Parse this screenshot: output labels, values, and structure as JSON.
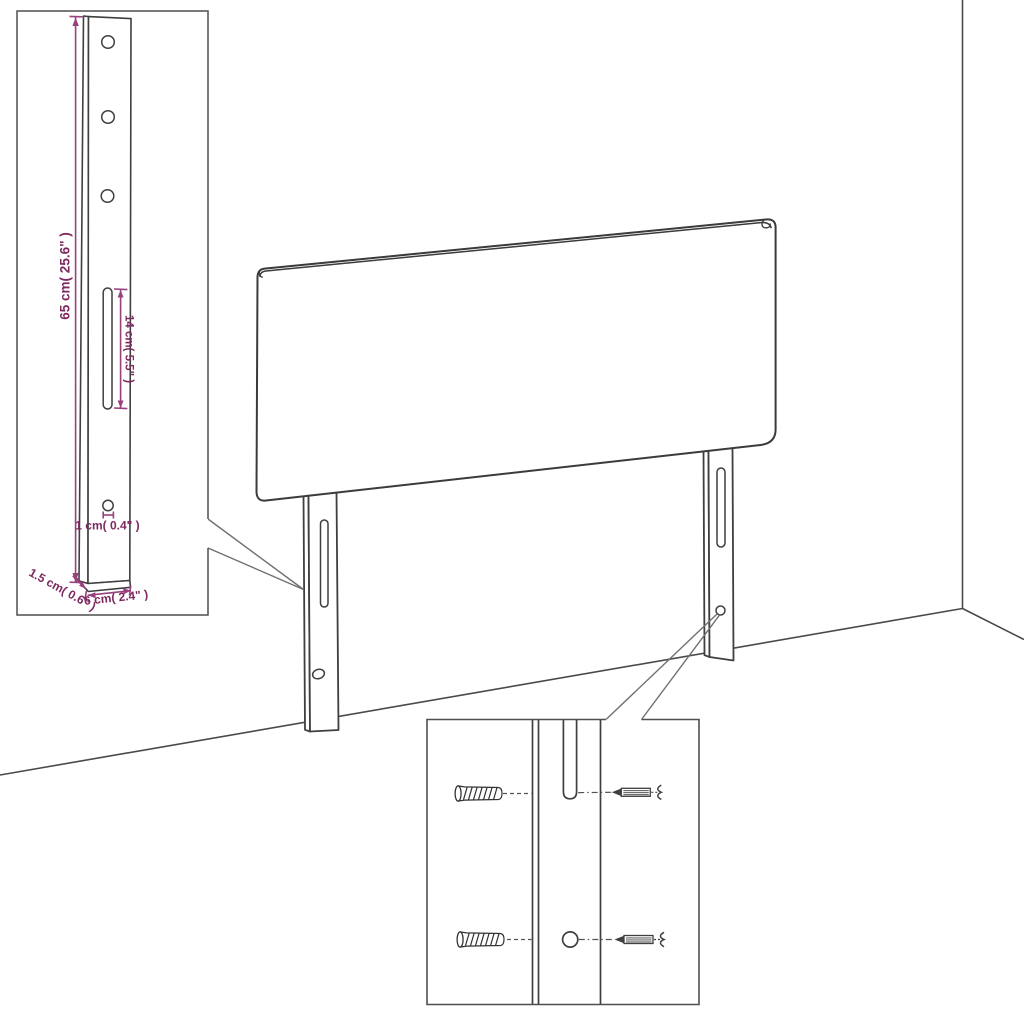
{
  "diagram": {
    "type": "headboard-assembly-dimension-diagram",
    "labels": {
      "bracket_height": "65 cm( 25.6\" )",
      "slot_length": "14 cm( 5.5\" )",
      "hole_diameter": "1 cm( 0.4\" )",
      "bracket_depth": "1.5 cm( 0.6\" )",
      "bracket_width": "6 cm( 2.4\" )"
    },
    "colors": {
      "dimension_text": "#7D2960",
      "dimension_line": "#97417E",
      "outline": "#3F3F3F",
      "callout_line": "#707070",
      "box_border": "#4F4F4F",
      "background": "#FFFFFF"
    },
    "icons": {
      "wall_plug": "wall-plug-icon",
      "screw": "screw-icon"
    }
  }
}
